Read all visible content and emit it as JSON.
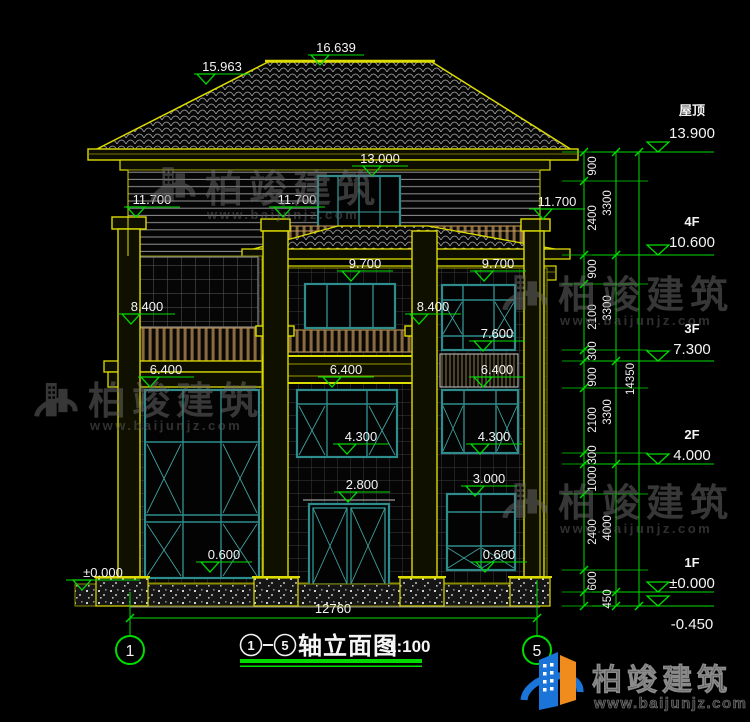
{
  "title": {
    "axis_start": "1",
    "axis_end": "5",
    "name": "轴立面图",
    "scale": "1:100"
  },
  "axes": {
    "left_bubble": "1",
    "right_bubble": "5"
  },
  "levels": {
    "right_markers": [
      {
        "label": "屋顶",
        "value": "13.900"
      },
      {
        "label": "4F",
        "value": "10.600"
      },
      {
        "label": "3F",
        "value": "7.300"
      },
      {
        "label": "2F",
        "value": "4.000"
      },
      {
        "label": "1F",
        "value": "±0.000"
      },
      {
        "label": "",
        "value": "-0.450"
      }
    ],
    "spot": {
      "ridge": "16.639",
      "roof_break": "15.963",
      "f4_door_head": "13.000",
      "f4_balcony": "11.700",
      "f3_porch_top": "9.700",
      "f3_rail_top": "8.400",
      "f3_window_sill": "7.600",
      "f2_window_head": "6.400",
      "f2_window_sill": "4.300",
      "f1_window_head": "3.000",
      "f1_door_head": "2.800",
      "f1_window_sill": "0.600",
      "ground": "±0.000"
    }
  },
  "dimensions": {
    "inner": [
      "900",
      "2400",
      "900",
      "2100",
      "300",
      "900",
      "2100",
      "300",
      "1000",
      "2400",
      "600"
    ],
    "middle": [
      "3300",
      "3300",
      "3300",
      "4000",
      "450"
    ],
    "total_height": "14350",
    "total_width": "12760"
  },
  "watermark": {
    "brand": "柏竣建筑",
    "url": "www.baijunjz.com"
  },
  "logo": {
    "brand": "柏竣建筑",
    "url": "www.baijunjz.com"
  },
  "colors": {
    "dim_green": "#00DC00",
    "cad_yellow": "#DCDC00",
    "window_teal": "#2E8C8C",
    "railing_brown": "#8A6A40",
    "lamp_red": "#E01010",
    "logo_blue": "#1B74D8",
    "logo_orange": "#F08C1E",
    "text_white": "#F2F2F2"
  }
}
